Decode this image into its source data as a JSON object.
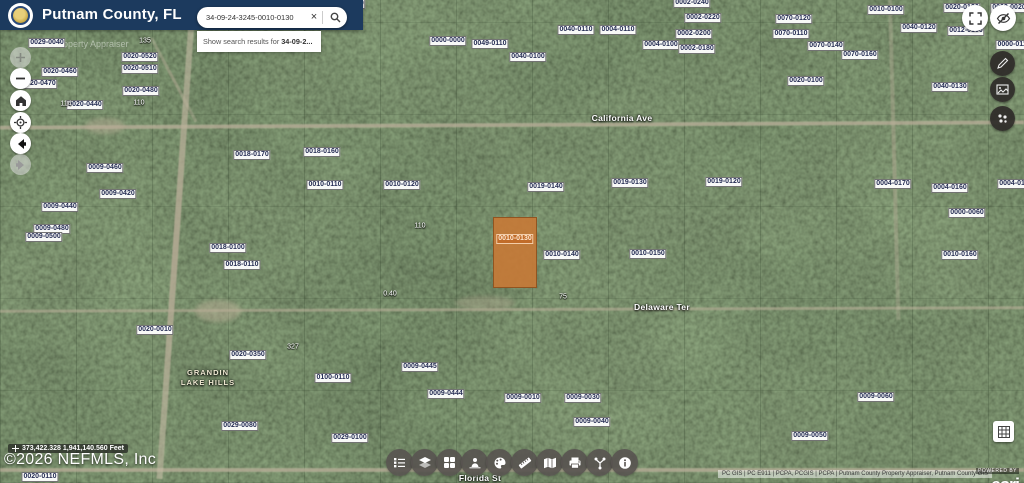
{
  "header": {
    "title": "Putnam County, FL",
    "watermark": "Property Appraiser"
  },
  "search": {
    "value": "34-09-24-3245-0010-0130",
    "clear_glyph": "×",
    "suggestion_prefix": "Show search results for",
    "suggestion_bold": "34-09-2..."
  },
  "statusbar": {
    "coordinates": "373,422.328 1,941,140.560 Feet",
    "copyright": "©2026 NEFMLS, Inc"
  },
  "attribution": {
    "sources": "PC GIS  |  PC E911  |  PCPA, PCGIS  |  PCPA  |  Putnam County Property Appraiser, Putnam County GIS",
    "powered_by": "POWERED BY",
    "brand": "esri"
  },
  "colors": {
    "header_navy": "#1c3a5e",
    "selected_parcel_fill": "#c67a37",
    "road_sand": "#b2a892",
    "forest_base": "#36422e"
  },
  "map": {
    "streets": [
      {
        "name": "California Ave",
        "x": 622,
        "y": 118
      },
      {
        "name": "Delaware Ter",
        "x": 662,
        "y": 307
      },
      {
        "name": "Florida St",
        "x": 480,
        "y": 478
      }
    ],
    "subdivision": {
      "line1": "GRANDIN",
      "line2": "LAKE HILLS",
      "x": 208,
      "y": 368
    },
    "selected_parcel": {
      "label": "0010-0130",
      "x": 493,
      "y": 217,
      "w": 44,
      "h": 71
    },
    "parcel_labels": [
      {
        "t": "0029-0040",
        "x": 47,
        "y": 43
      },
      {
        "t": "0020-0520",
        "x": 140,
        "y": 57
      },
      {
        "t": "0020-0510",
        "x": 140,
        "y": 69
      },
      {
        "t": "0020-0460",
        "x": 60,
        "y": 72
      },
      {
        "t": "0020-0470",
        "x": 39,
        "y": 84
      },
      {
        "t": "0020-0480",
        "x": 141,
        "y": 91
      },
      {
        "t": "0020-0440",
        "x": 85,
        "y": 105
      },
      {
        "t": "0009-0460",
        "x": 105,
        "y": 168
      },
      {
        "t": "0009-0420",
        "x": 118,
        "y": 194
      },
      {
        "t": "0009-0440",
        "x": 60,
        "y": 207
      },
      {
        "t": "0009-0480",
        "x": 52,
        "y": 229
      },
      {
        "t": "0009-0500",
        "x": 44,
        "y": 237
      },
      {
        "t": "0040-0180",
        "x": 347,
        "y": 4
      },
      {
        "t": "0000-0000",
        "x": 448,
        "y": 41
      },
      {
        "t": "0049-0110",
        "x": 490,
        "y": 44
      },
      {
        "t": "0040-0100",
        "x": 528,
        "y": 57
      },
      {
        "t": "0040-0110",
        "x": 576,
        "y": 30
      },
      {
        "t": "0004-0110",
        "x": 618,
        "y": 30
      },
      {
        "t": "0004-0100",
        "x": 661,
        "y": 45
      },
      {
        "t": "0002-0240",
        "x": 692,
        "y": 3
      },
      {
        "t": "0002-0220",
        "x": 703,
        "y": 18
      },
      {
        "t": "0002-0200",
        "x": 694,
        "y": 34
      },
      {
        "t": "0002-0180",
        "x": 697,
        "y": 49
      },
      {
        "t": "0070-0120",
        "x": 794,
        "y": 19
      },
      {
        "t": "0070-0110",
        "x": 791,
        "y": 34
      },
      {
        "t": "0070-0140",
        "x": 826,
        "y": 46
      },
      {
        "t": "0070-0160",
        "x": 860,
        "y": 55
      },
      {
        "t": "0020-0100",
        "x": 806,
        "y": 81
      },
      {
        "t": "0010-0100",
        "x": 886,
        "y": 10
      },
      {
        "t": "0040-0120",
        "x": 919,
        "y": 28
      },
      {
        "t": "0020-0130",
        "x": 962,
        "y": 8
      },
      {
        "t": "0002-0020",
        "x": 1009,
        "y": 8
      },
      {
        "t": "0012-0150",
        "x": 966,
        "y": 31
      },
      {
        "t": "0000-0110",
        "x": 1014,
        "y": 45
      },
      {
        "t": "0040-0130",
        "x": 950,
        "y": 87
      },
      {
        "t": "0004-0170",
        "x": 893,
        "y": 184
      },
      {
        "t": "0004-0160",
        "x": 950,
        "y": 188
      },
      {
        "t": "0004-0150",
        "x": 1016,
        "y": 184
      },
      {
        "t": "0000-0060",
        "x": 967,
        "y": 213
      },
      {
        "t": "0010-0160",
        "x": 960,
        "y": 255
      },
      {
        "t": "0018-0170",
        "x": 252,
        "y": 155
      },
      {
        "t": "0018-0160",
        "x": 322,
        "y": 152
      },
      {
        "t": "0010-0110",
        "x": 325,
        "y": 185
      },
      {
        "t": "0010-0120",
        "x": 402,
        "y": 185
      },
      {
        "t": "0019-0140",
        "x": 546,
        "y": 187
      },
      {
        "t": "0019-0130",
        "x": 630,
        "y": 183
      },
      {
        "t": "0019-0120",
        "x": 724,
        "y": 182
      },
      {
        "t": "0010-0140",
        "x": 562,
        "y": 255
      },
      {
        "t": "0010-0150",
        "x": 648,
        "y": 254
      },
      {
        "t": "0018-0100",
        "x": 228,
        "y": 248
      },
      {
        "t": "0018-0110",
        "x": 242,
        "y": 265
      },
      {
        "t": "0020-0010",
        "x": 155,
        "y": 330
      },
      {
        "t": "0020-0350",
        "x": 248,
        "y": 355
      },
      {
        "t": "0100-0110",
        "x": 333,
        "y": 378
      },
      {
        "t": "0009-0445",
        "x": 420,
        "y": 367
      },
      {
        "t": "0009-0444",
        "x": 446,
        "y": 394
      },
      {
        "t": "0009-0010",
        "x": 523,
        "y": 398
      },
      {
        "t": "0009-0030",
        "x": 583,
        "y": 398
      },
      {
        "t": "0009-0040",
        "x": 592,
        "y": 422
      },
      {
        "t": "0009-0050",
        "x": 810,
        "y": 436
      },
      {
        "t": "0009-0060",
        "x": 876,
        "y": 397
      },
      {
        "t": "0029-0100",
        "x": 350,
        "y": 438
      },
      {
        "t": "0029-0080",
        "x": 240,
        "y": 426
      },
      {
        "t": "0020-0110",
        "x": 40,
        "y": 477
      }
    ],
    "dimension_labels": [
      {
        "t": "135",
        "x": 145,
        "y": 41
      },
      {
        "t": "110",
        "x": 139,
        "y": 103
      },
      {
        "t": "114",
        "x": 66,
        "y": 104
      },
      {
        "t": "110",
        "x": 420,
        "y": 226
      },
      {
        "t": "327",
        "x": 293,
        "y": 347
      },
      {
        "t": "0.40",
        "x": 390,
        "y": 294
      },
      {
        "t": "75",
        "x": 563,
        "y": 297
      }
    ]
  }
}
